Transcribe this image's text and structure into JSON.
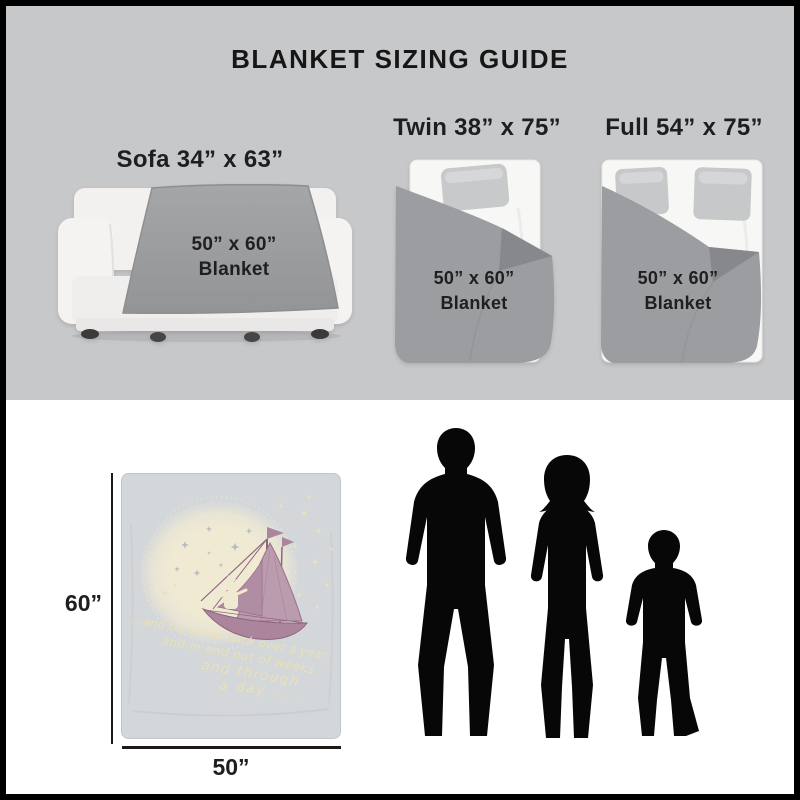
{
  "title": "BLANKET SIZING GUIDE",
  "sections": {
    "sofa": {
      "label": "Sofa 34” x 63”",
      "blanket_size": "50” x 60”",
      "blanket_word": "Blanket"
    },
    "twin": {
      "label": "Twin 38” x 75”",
      "blanket_size": "50” x 60”",
      "blanket_word": "Blanket"
    },
    "full": {
      "label": "Full 54” x 75”",
      "blanket_size": "50” x 60”",
      "blanket_word": "Blanket"
    }
  },
  "product_blanket": {
    "height_label": "60”",
    "width_label": "50”",
    "quote_line1": "...and he sailed back over a year",
    "quote_line2": "and in and out of weeks",
    "quote_line3": "and through",
    "quote_line4": "a day . . ."
  },
  "figures": {
    "man": "adult-man-silhouette",
    "woman": "adult-woman-silhouette",
    "boy": "child-boy-silhouette"
  },
  "colors": {
    "frame_border": "#000000",
    "top_band_gray": "#c7c8ca",
    "bottom_band_white": "#ffffff",
    "blanket_gray": "#9c9da0",
    "blanket_fold_gray": "#87888b",
    "bed_white": "#f7f7f5",
    "pillow_gray": "#c7c9cb",
    "product_blanket_bg": "#d4d7da",
    "moon_glow_cream": "#f0ead3",
    "sail_mauve": "#bb9cae",
    "hull_mauve": "#aa859b",
    "quote_cream": "#e9e0b6",
    "silhouette_black": "#070707",
    "text_dark": "#1d1d1d"
  }
}
